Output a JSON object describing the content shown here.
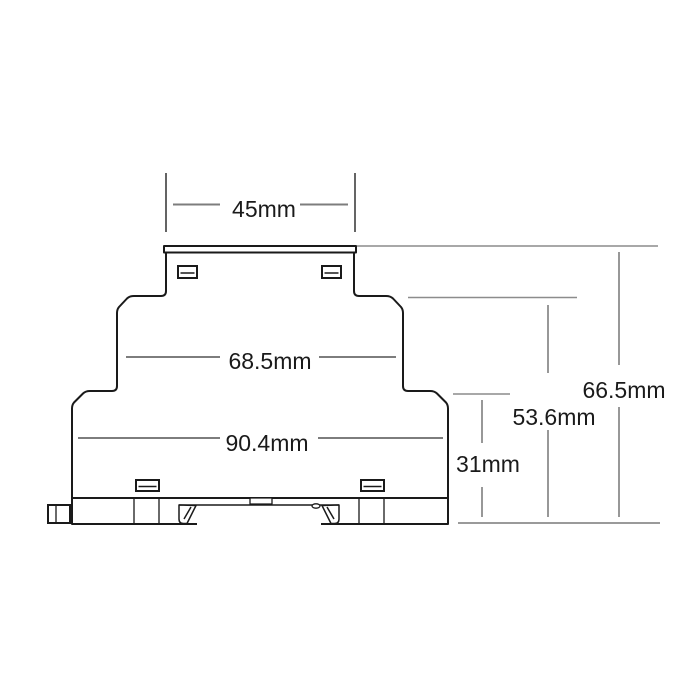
{
  "figure": {
    "kind": "technical-dimension-drawing",
    "subject": "din-rail-module-side-profile",
    "unit": "mm",
    "colors": {
      "background": "#ffffff",
      "outline": "#1a1a1a",
      "dimension_line": "#7d7d7d",
      "extension_line_dark": "#3e3e3e",
      "extension_line_light": "#8c8c8c",
      "label_text": "#1a1a1a"
    }
  },
  "dimensions": {
    "top_width": {
      "label": "45mm"
    },
    "upper_body_width": {
      "label": "68.5mm"
    },
    "lower_body_width": {
      "label": "90.4mm"
    },
    "base_height": {
      "label": "31mm"
    },
    "body_height": {
      "label": "53.6mm"
    },
    "overall_height": {
      "label": "66.5mm"
    }
  }
}
